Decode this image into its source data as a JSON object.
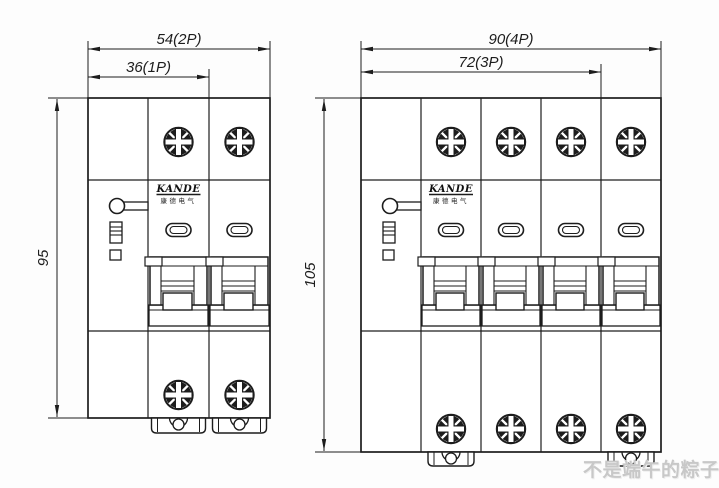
{
  "page": {
    "background": "#fdfdfd",
    "line_color": "#1d1d1d"
  },
  "watermark": {
    "text": "不是端午的粽子",
    "color": "#c8c8c8"
  },
  "brand": {
    "name": "KANDE",
    "chinese": "康德电气"
  },
  "drawings": [
    {
      "name": "2-pole-breaker-front-view",
      "poles": 2,
      "dim_width_outer": "54(2P)",
      "dim_width_inner": "36(1P)",
      "dim_height": "95"
    },
    {
      "name": "4-pole-breaker-front-view",
      "poles": 4,
      "dim_width_outer": "90(4P)",
      "dim_width_inner": "72(3P)",
      "dim_height": "105"
    }
  ]
}
